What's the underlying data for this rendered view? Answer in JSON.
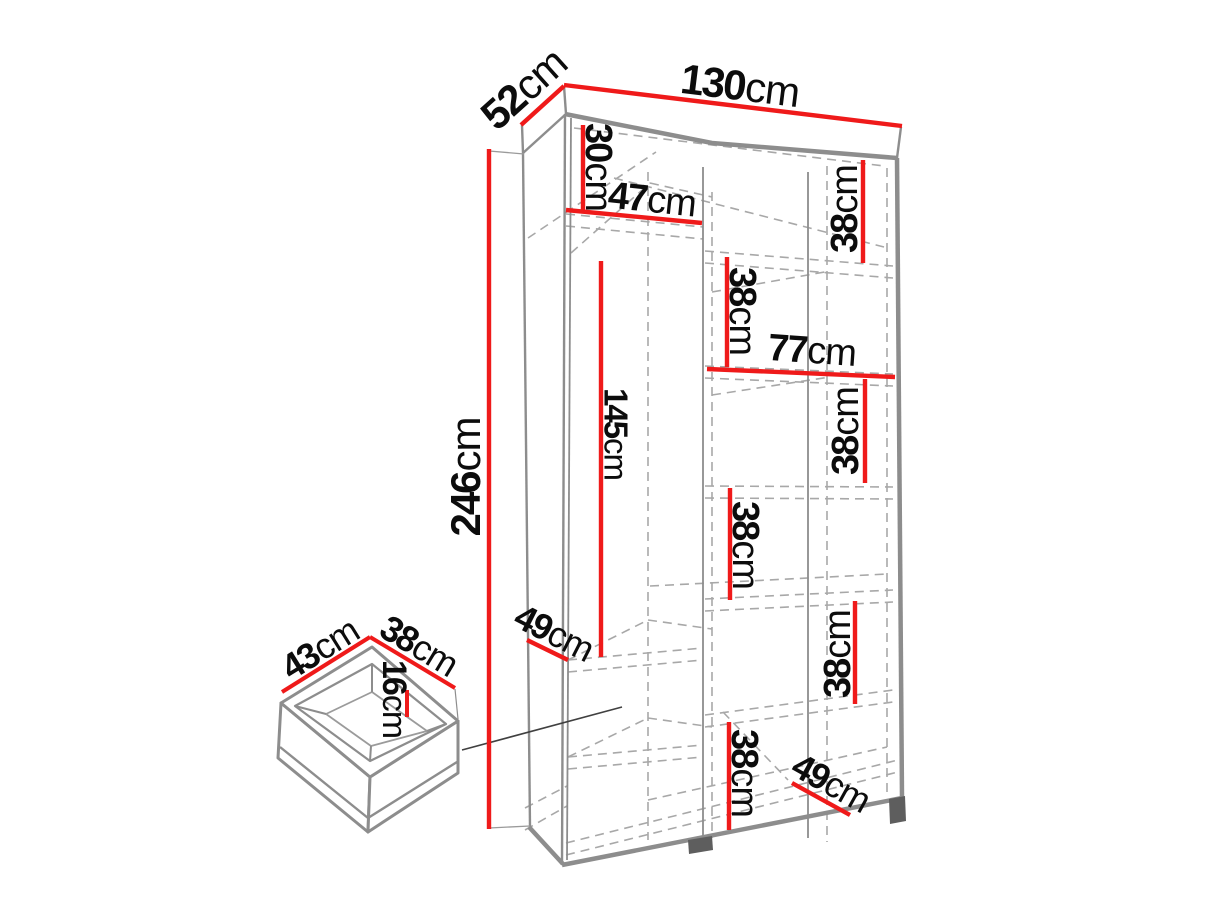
{
  "diagram_type": "wardrobe-dimension-drawing",
  "colors": {
    "dimension_line_red": "#ef1a1a",
    "structure_gray": "#8d8d8d",
    "hidden_edge_gray": "#a8a8a8",
    "label_black": "#0c0c0c",
    "foot_dark_gray": "#5e5e5e",
    "background": "#ffffff"
  },
  "labels": {
    "depth_top": {
      "num": "52",
      "unit": "cm"
    },
    "width_top": {
      "num": "130",
      "unit": "cm"
    },
    "height_left": {
      "num": "246",
      "unit": "cm"
    },
    "top_shelf_gap": {
      "num": "30",
      "unit": "cm"
    },
    "left_col_width": {
      "num": "47",
      "unit": "cm"
    },
    "right_gap_1": {
      "num": "38",
      "unit": "cm"
    },
    "mid_gap_1": {
      "num": "38",
      "unit": "cm"
    },
    "right_section_width": {
      "num": "77",
      "unit": "cm"
    },
    "right_gap_2": {
      "num": "38",
      "unit": "cm"
    },
    "hanging_height": {
      "num": "145",
      "unit": "cm"
    },
    "mid_gap_2": {
      "num": "38",
      "unit": "cm"
    },
    "left_shelf_depth": {
      "num": "49",
      "unit": "cm"
    },
    "right_gap_3": {
      "num": "38",
      "unit": "cm"
    },
    "mid_gap_3": {
      "num": "38",
      "unit": "cm"
    },
    "bottom_shelf_depth": {
      "num": "49",
      "unit": "cm"
    },
    "drawer_depth": {
      "num": "43",
      "unit": "cm"
    },
    "drawer_width": {
      "num": "38",
      "unit": "cm"
    },
    "drawer_height": {
      "num": "16",
      "unit": "cm"
    }
  }
}
